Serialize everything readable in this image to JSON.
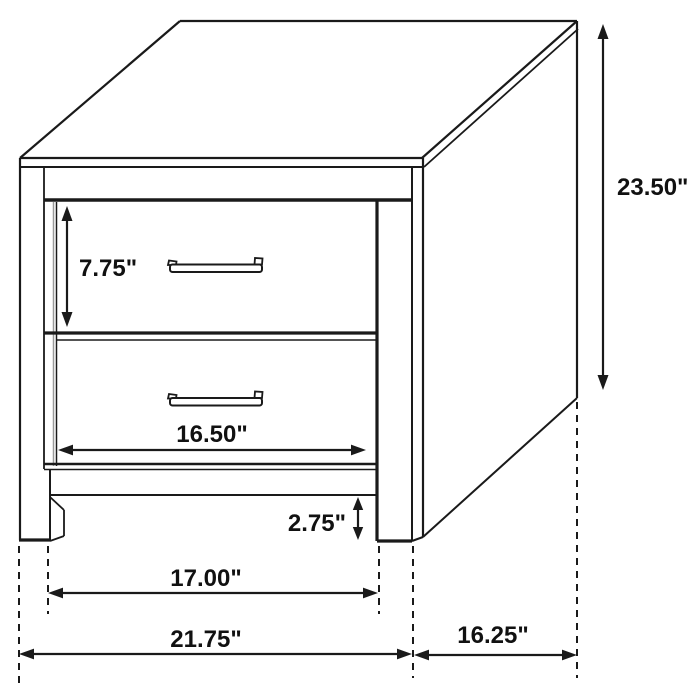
{
  "diagram": {
    "subject": "two-drawer nightstand dimension drawing",
    "background_color": "#ffffff",
    "line_color": "#1a1a1a",
    "labels": {
      "drawer_height": "7.75\"",
      "overall_height": "23.50\"",
      "drawer_width": "16.50\"",
      "base_clearance": "2.75\"",
      "inner_leg_span": "17.00\"",
      "overall_width": "21.75\"",
      "overall_depth": "16.25\""
    }
  }
}
